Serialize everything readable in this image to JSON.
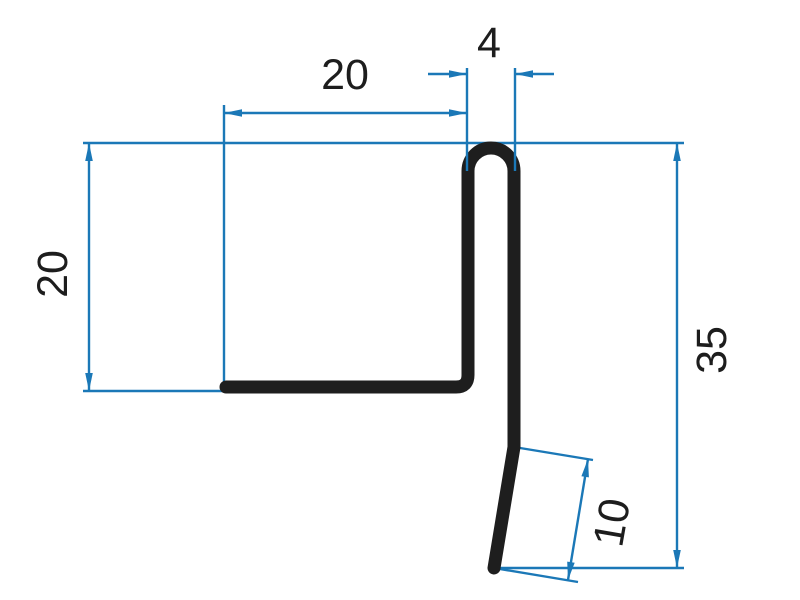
{
  "drawing": {
    "background": "#ffffff",
    "profile_color": "#1e1e1e",
    "dimension_color": "#1b78b7",
    "text_color": "#1d1d1d",
    "labels": {
      "top_width": "20",
      "hem_width": "4",
      "left_height": "20",
      "total_height": "35",
      "drip_length": "10"
    }
  }
}
